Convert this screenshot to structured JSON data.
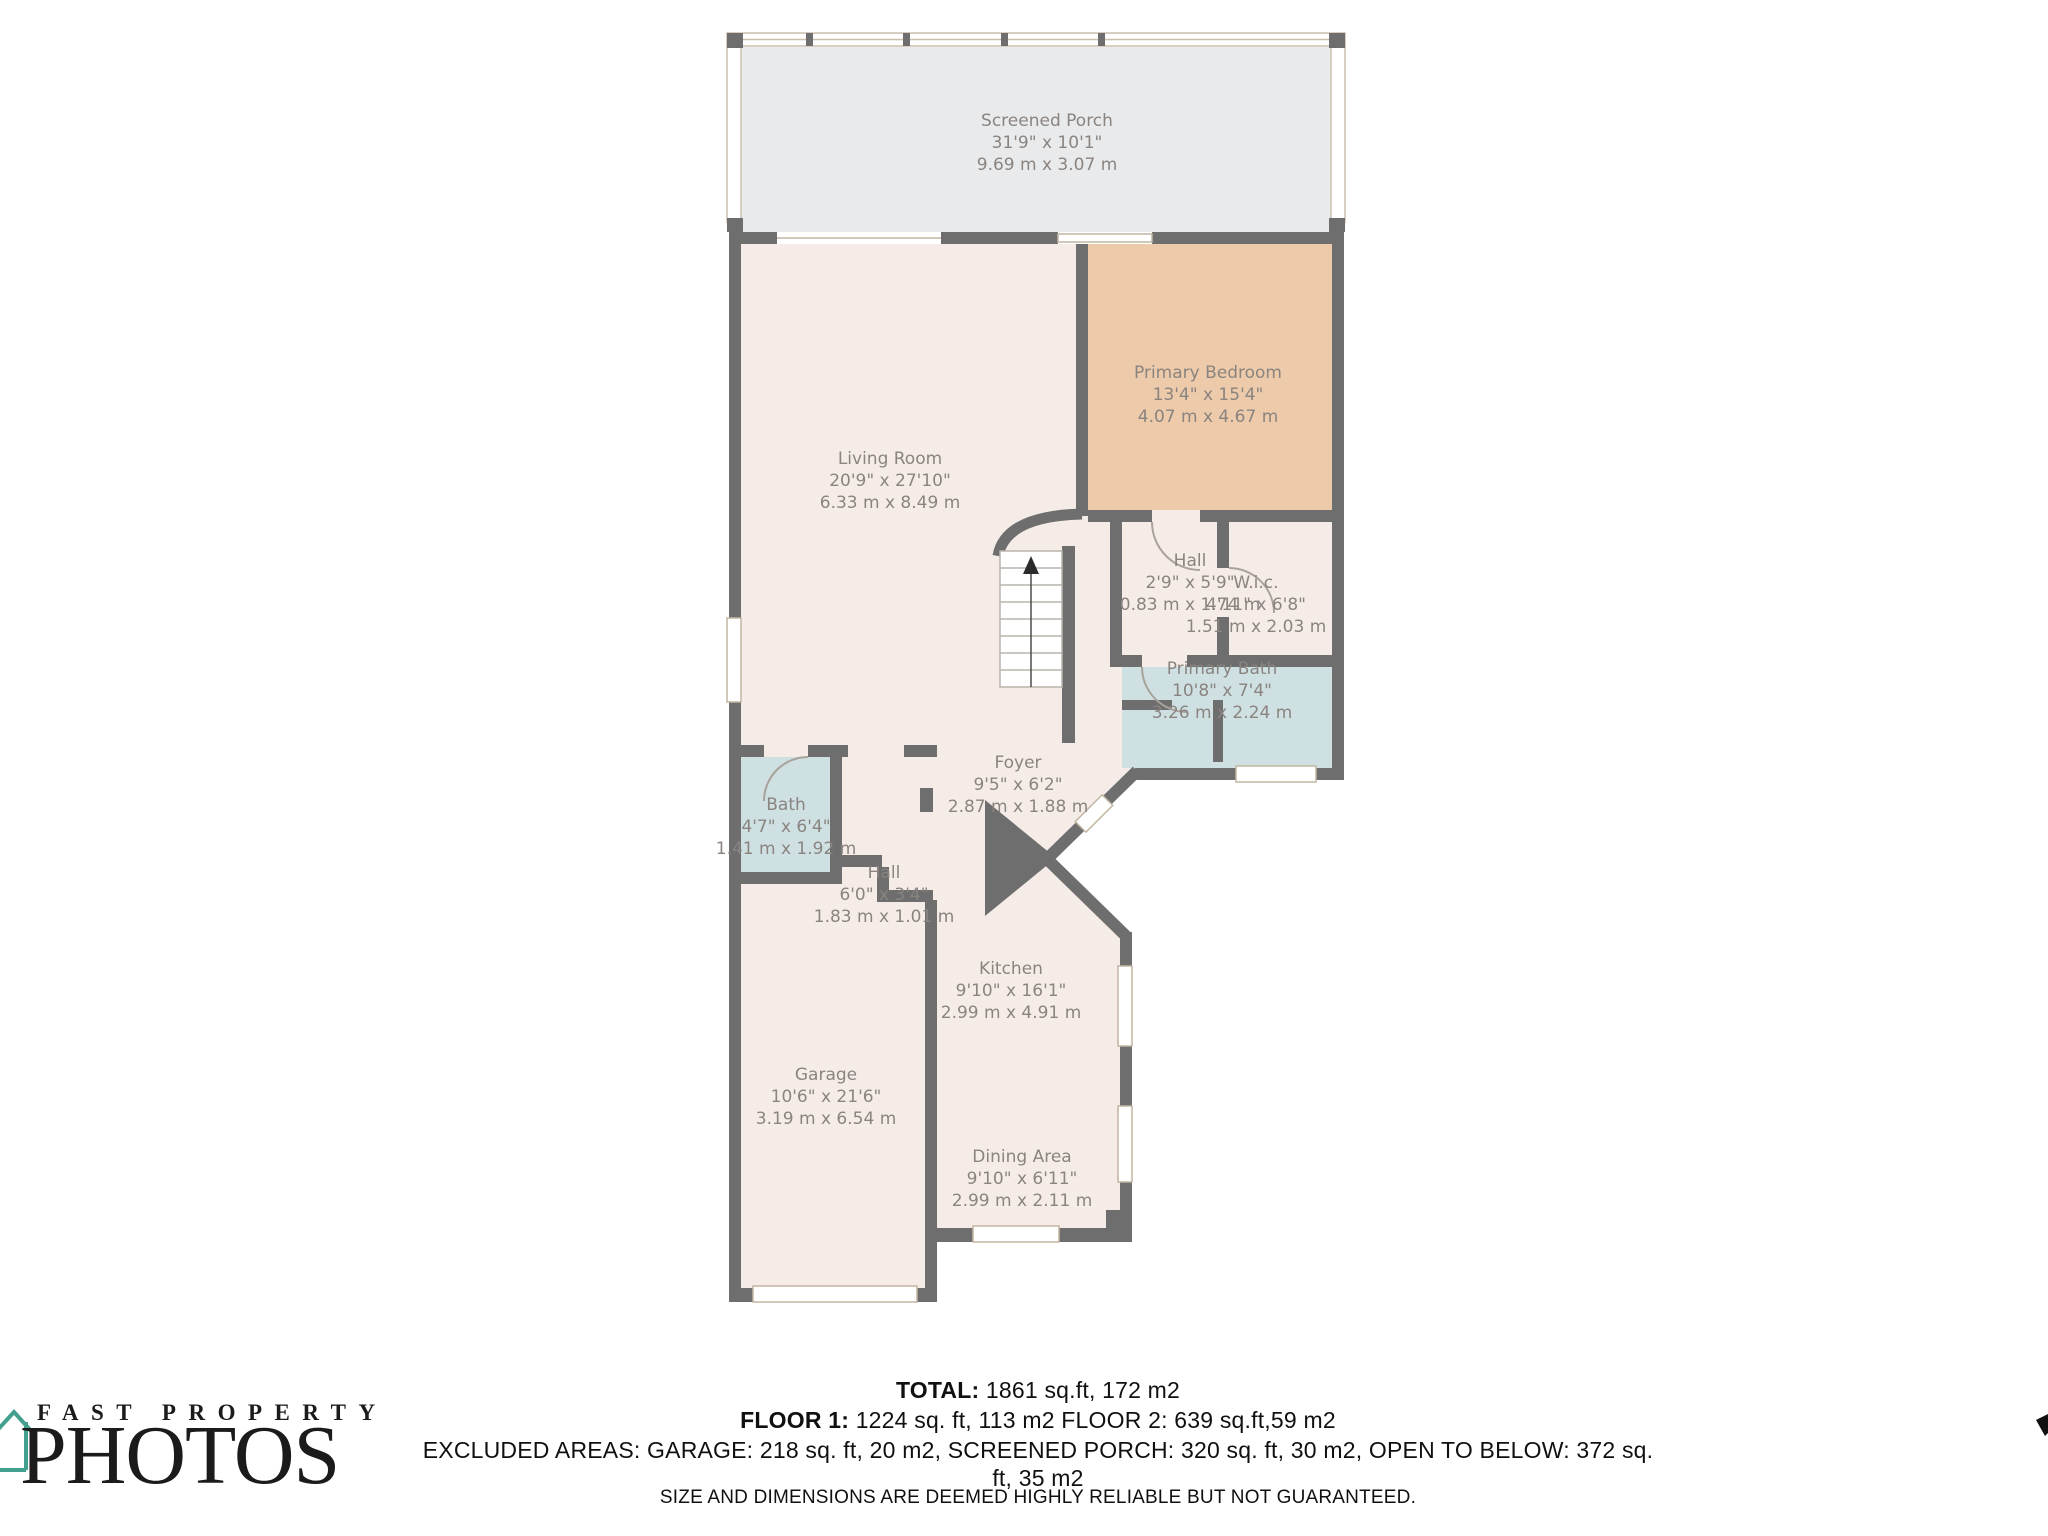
{
  "rooms": [
    {
      "name": "Screened Porch",
      "dims_ft": "31'9\" x 10'1\"",
      "dims_m": "9.69 m x 3.07 m"
    },
    {
      "name": "Living Room",
      "dims_ft": "20'9\" x 27'10\"",
      "dims_m": "6.33 m x 8.49 m"
    },
    {
      "name": "Primary Bedroom",
      "dims_ft": "13'4\" x 15'4\"",
      "dims_m": "4.07 m x 4.67 m"
    },
    {
      "name": "Hall",
      "dims_ft": "2'9\" x 5'9\"",
      "dims_m": "0.83 m x 1.74 m"
    },
    {
      "name": "W.i.c.",
      "dims_ft": "4'11\" x 6'8\"",
      "dims_m": "1.51 m x 2.03 m"
    },
    {
      "name": "Primary Bath",
      "dims_ft": "10'8\" x 7'4\"",
      "dims_m": "3.26 m x 2.24 m"
    },
    {
      "name": "Foyer",
      "dims_ft": "9'5\" x 6'2\"",
      "dims_m": "2.87 m x 1.88 m"
    },
    {
      "name": "Bath",
      "dims_ft": "4'7\" x 6'4\"",
      "dims_m": "1.41 m x 1.92 m"
    },
    {
      "name": "Hall",
      "dims_ft": "6'0\" x 3'4\"",
      "dims_m": "1.83 m x 1.01 m"
    },
    {
      "name": "Kitchen",
      "dims_ft": "9'10\" x 16'1\"",
      "dims_m": "2.99 m x 4.91 m"
    },
    {
      "name": "Garage",
      "dims_ft": "10'6\" x 21'6\"",
      "dims_m": "3.19 m x 6.54 m"
    },
    {
      "name": "Dining Area",
      "dims_ft": "9'10\" x 6'11\"",
      "dims_m": "2.99 m x 2.11 m"
    }
  ],
  "footer": {
    "total_label": "TOTAL:",
    "total_value": "1861 sq.ft, 172 m2",
    "floor1_label": "FLOOR 1:",
    "floor1_value": "1224 sq. ft, 113 m2",
    "floor2_text": "FLOOR 2: 639 sq.ft,59 m2",
    "excluded": "EXCLUDED AREAS: GARAGE: 218 sq. ft, 20 m2, SCREENED PORCH: 320 sq. ft, 30 m2, OPEN TO BELOW: 372 sq. ft, 35 m2",
    "disclaimer": "SIZE AND DIMENSIONS ARE DEEMED HIGHLY RELIABLE BUT NOT GUARANTEED."
  },
  "logo": {
    "line1": "FAST PROPERTY",
    "line2": "PHOTOS"
  },
  "colors": {
    "wall": "#6e6e6e",
    "room_floor": "#f5ece7",
    "bedroom_floor": "#edcaa9",
    "bath_floor": "#cfe0e2",
    "porch_floor": "#e9eaeb",
    "window_frame": "#c3b5a3",
    "label_text": "#8a8480",
    "logo_house": "#43a08e"
  }
}
